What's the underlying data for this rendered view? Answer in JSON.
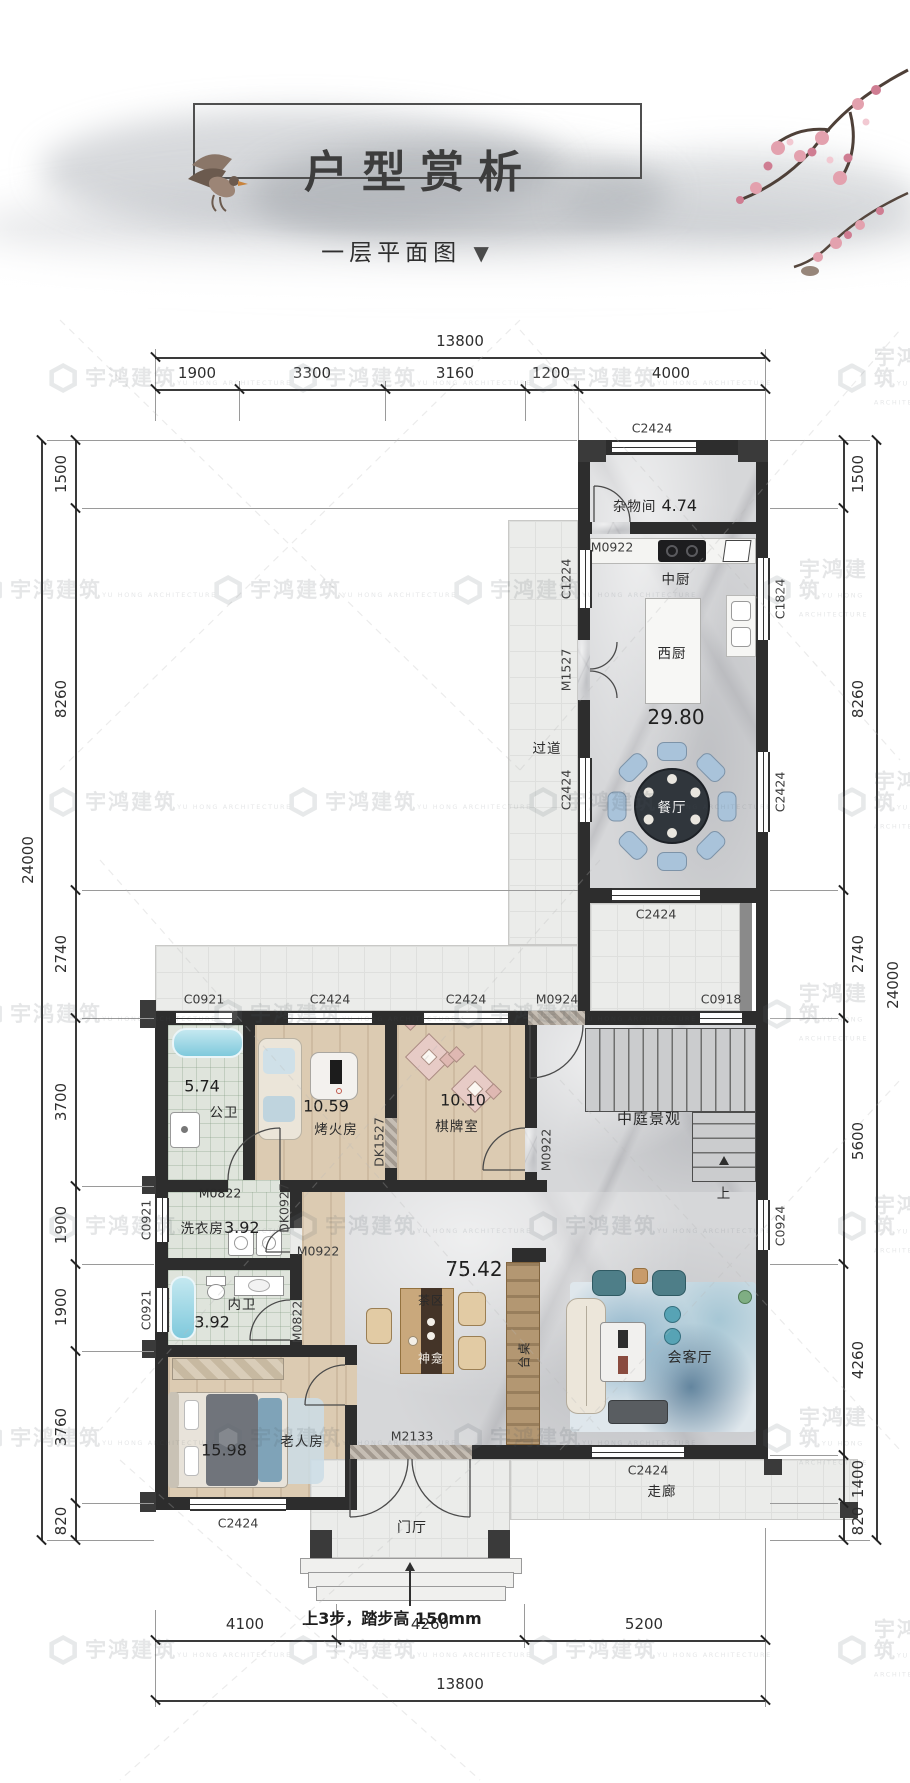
{
  "page": {
    "title": "户型赏析",
    "subtitle": "一层平面图",
    "subtitle_marker": "▼"
  },
  "watermark": {
    "cn": "宇鸿建筑",
    "en": "YU HONG ARCHITECTURE"
  },
  "note": {
    "steps": "上3步，踏步高 150mm"
  },
  "dimensions": {
    "top": {
      "total": "13800",
      "segments": [
        "1900",
        "3300",
        "3160",
        "1200",
        "4000"
      ]
    },
    "bottom": {
      "total": "13800",
      "segments": [
        "4100",
        "4260",
        "5200"
      ]
    },
    "left": {
      "total": "24000",
      "segments": [
        "1500",
        "8260",
        "2740",
        "3700",
        "1900",
        "1900",
        "3760",
        "820"
      ]
    },
    "right": {
      "total": "24000",
      "segments": [
        "1500",
        "8260",
        "2740",
        "5600",
        "4260",
        "1400",
        "820"
      ]
    }
  },
  "rooms": {
    "zawujian": {
      "name": "杂物间",
      "area": "4.74"
    },
    "zhongchu": {
      "name": "中厨"
    },
    "xichu": {
      "name": "西厨"
    },
    "canting": {
      "name": "餐厅",
      "area": "29.80"
    },
    "guodao": {
      "name": "过道"
    },
    "gongwei": {
      "name": "公卫",
      "area": "5.74"
    },
    "kaohuofang": {
      "name": "烤火房",
      "area": "10.59"
    },
    "qipaishi": {
      "name": "棋牌室",
      "area": "10.10"
    },
    "zhongting": {
      "name": "中庭景观"
    },
    "stairs_up": {
      "name": "上"
    },
    "xiyifang": {
      "name": "洗衣房",
      "area": "3.92"
    },
    "neiwei": {
      "name": "内卫",
      "area": "3.92"
    },
    "laorenfang": {
      "name": "老人房",
      "area": "15.98"
    },
    "living": {
      "area": "75.42"
    },
    "chaqu": {
      "name": "茶区"
    },
    "shenkan": {
      "name": "神龛"
    },
    "taizhuo": {
      "name": "台桌"
    },
    "huiketing": {
      "name": "会客厅"
    },
    "menting": {
      "name": "门厅"
    },
    "zoulang": {
      "name": "走廊"
    }
  },
  "openings": {
    "c2424": "C2424",
    "c1224": "C1224",
    "c1824": "C1824",
    "c0921": "C0921",
    "c0918": "C0918",
    "c0924": "C0924",
    "m0922": "M0922",
    "m0822": "M0822",
    "m0924": "M0924",
    "m1527": "M1527",
    "m2133": "M2133",
    "dk1527": "DK1527",
    "dk0927": "DK0927"
  },
  "colors": {
    "wall": "#2d2d2d",
    "chair_blue": "#a9c3da",
    "teal": "#4e7e88",
    "tub_blue": "#7fc9dc"
  }
}
